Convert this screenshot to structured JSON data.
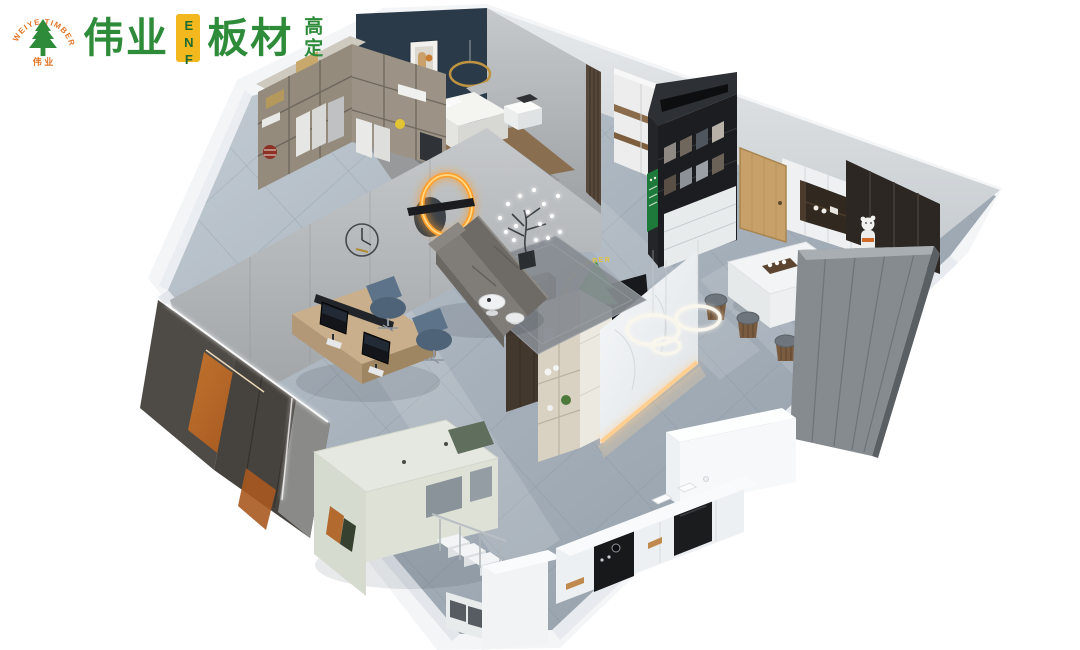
{
  "logo": {
    "arc_text": "WEIYE TIMBER",
    "tree_caption": "伟 业",
    "brand": "伟业",
    "badge": "ENF",
    "product": "板材",
    "tagline_vertical": "高定"
  },
  "reception_sign": {
    "arc_text": "WEIYE TIMBER"
  },
  "colors": {
    "brand_green": "#2e8b3a",
    "brand_orange": "#e2762a",
    "badge_yellow": "#f2b81d",
    "badge_text_green": "#1e6b2f",
    "sign_green": "#3fae4a",
    "sign_arc_yellow": "#e3c23a",
    "accent_wall_navy": "#2b3a49",
    "cut_wall_white": "#f3f5f7",
    "floor_gray": "#a8b2bc",
    "tile_line": "#7e8994",
    "wood_oak": "#c9af8b",
    "cabinet_dark": "#4e4a45",
    "cabinet_orange": "#b2652c",
    "led_warm": "#ffcf92",
    "glow_orange": "#ff9e2c",
    "rack_black": "#1b1d20",
    "poster_green": "#1e7a3b",
    "door_wood": "#c7a06a",
    "sofa_gray": "#807c77",
    "chair_blue": "#5d7389",
    "loft_sage": "#e5e8e0",
    "marble_white": "#f5f7f8",
    "partition_gray": "#868b90",
    "partition_brown": "#43382e",
    "closet_taupe": "#948b7d"
  },
  "scene": {
    "type": "isometric-cutaway-3d-render",
    "description": "Cutaway 3D render of a small apartment showroom for ENF-grade board brand",
    "areas": [
      {
        "name": "bedroom",
        "objects": [
          "navy-accent-wall",
          "art-frame",
          "gold-ring-chandelier",
          "walk-in-closet",
          "bed",
          "nightstand"
        ]
      },
      {
        "name": "office",
        "objects": [
          "double-workstation-desk",
          "monitors",
          "blue-task-chairs",
          "storage-wall-orange-panels",
          "wall-clock",
          "eclipse-ring-wall-lamp"
        ]
      },
      {
        "name": "living",
        "objects": [
          "fabric-sofa",
          "area-rug",
          "round-coffee-tables",
          "firefly-branch-lamp"
        ]
      },
      {
        "name": "reception",
        "objects": [
          "brand-tree-sign",
          "marble-feature-panel-led",
          "island-counter",
          "ring-pendant-lights",
          "display-bookshelf",
          "walnut-partition"
        ]
      },
      {
        "name": "showroom-hall",
        "objects": [
          "panel-sample-rack",
          "green-poster",
          "sliding-wardrobe",
          "entry-door"
        ]
      },
      {
        "name": "tea-room",
        "objects": [
          "wall-cabinets",
          "display-niche",
          "dark-display-shelf",
          "bearbrick-figure",
          "marble-tea-table",
          "tea-set",
          "round-stools",
          "gray-partition-wall"
        ]
      },
      {
        "name": "kids-room",
        "objects": [
          "loft-bed",
          "staircase-with-railing",
          "under-stair-storage"
        ]
      },
      {
        "name": "kitchen",
        "objects": [
          "white-cabinet-run",
          "black-cooktop-inserts",
          "small-appliances",
          "tall-cabinet"
        ]
      }
    ]
  }
}
